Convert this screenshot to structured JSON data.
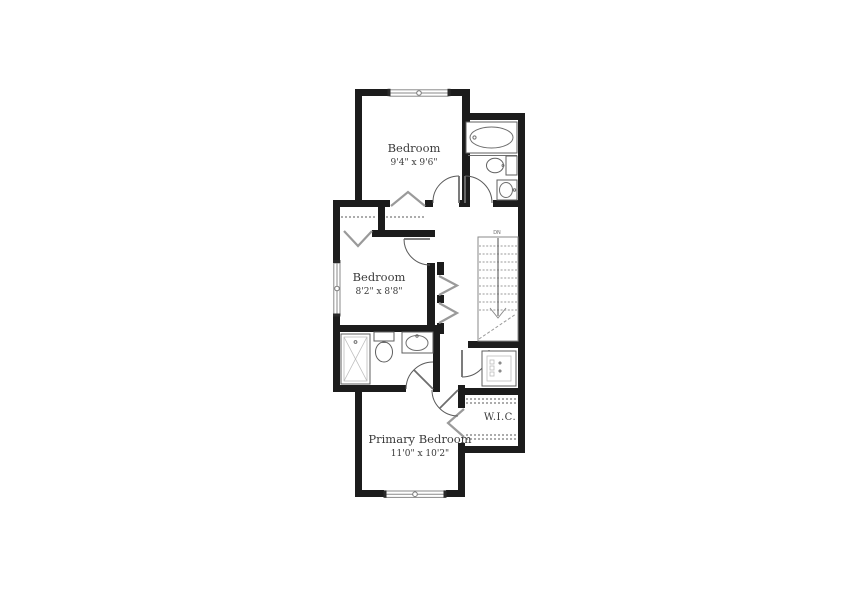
{
  "plan": {
    "rooms": {
      "bedroom_top": {
        "label": "Bedroom",
        "dims": "9'4\" x 9'6\""
      },
      "bedroom_mid": {
        "label": "Bedroom",
        "dims": "8'2\" x 8'8\""
      },
      "primary_bedroom": {
        "label": "Primary Bedroom",
        "dims": "11'0\" x 10'2\""
      },
      "walk_in_closet": {
        "label": "W.I.C."
      }
    },
    "stairs": {
      "label": "DN"
    },
    "icons": {
      "bathtub": "bathtub-icon",
      "toilet": "toilet-icon",
      "sink": "sink-icon",
      "shower": "shower-icon",
      "washer_dryer": "washer-dryer-icon",
      "window": "window-icon",
      "door_swing": "door-swing-icon",
      "bifold_chevron": "bifold-door-icon"
    },
    "colors": {
      "wall": "#1c1c1c",
      "fixture_line": "#5f5f5f",
      "closet_gray": "#9a9a9a",
      "text": "#3b3b3b",
      "background": "#ffffff"
    }
  }
}
